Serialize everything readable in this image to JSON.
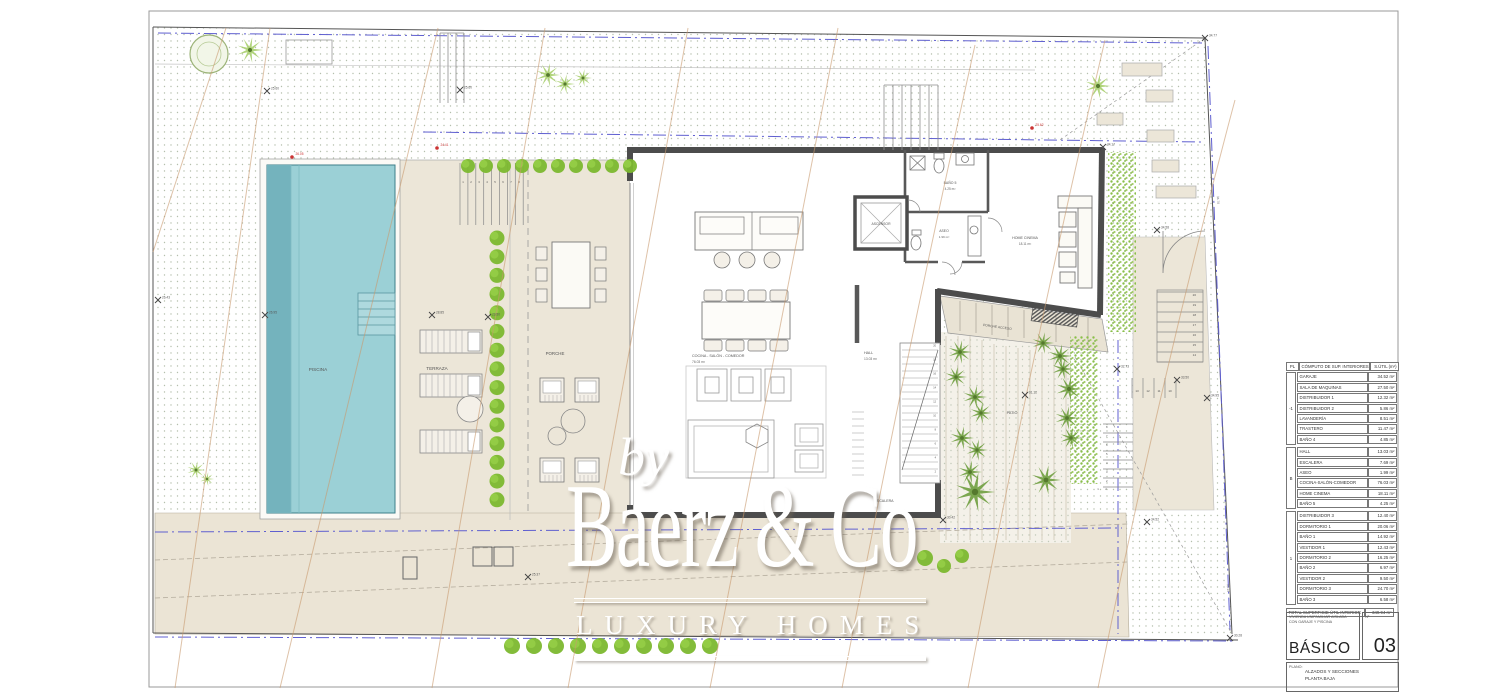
{
  "watermark": {
    "by": "by",
    "brand": "Baerz & Co",
    "tagline": "LUXURY HOMES"
  },
  "plan_labels": {
    "piscina": "PISCINA",
    "terraza": "TERRAZA",
    "porche": "PORCHE",
    "cocina": "COCINA - SALÓN - COMEDOR",
    "cocina_area": "76.03 m²",
    "hall": "HALL",
    "hall_area": "13.03 m²",
    "ascensor": "ASCENSOR",
    "aseo": "ASEO",
    "aseo_area": "1.99 m²",
    "bano5": "BAÑO 5",
    "bano5_area": "4.25 m²",
    "home_cinema": "HOME CINEMA",
    "home_cinema_area": "18.11 m²",
    "escalera": "ESCALERA",
    "patio": "PATIO",
    "porche_acceso": "PORCHE ACCESO"
  },
  "survey_marks": [
    {
      "x": 267,
      "y": 91,
      "v": "25.60"
    },
    {
      "x": 460,
      "y": 90,
      "v": "25.60"
    },
    {
      "x": 265,
      "y": 315,
      "v": "26.95"
    },
    {
      "x": 432,
      "y": 315,
      "v": "28.85"
    },
    {
      "x": 488,
      "y": 317,
      "v": "29.50"
    },
    {
      "x": 1025,
      "y": 395,
      "v": "31.12"
    },
    {
      "x": 1117,
      "y": 369,
      "v": "32.73"
    },
    {
      "x": 1177,
      "y": 380,
      "v": "33.50"
    },
    {
      "x": 1207,
      "y": 398,
      "v": "34.95"
    },
    {
      "x": 1103,
      "y": 147,
      "v": "34.17"
    },
    {
      "x": 1157,
      "y": 230,
      "v": "34.58"
    },
    {
      "x": 943,
      "y": 520,
      "v": "30.42"
    },
    {
      "x": 1147,
      "y": 522,
      "v": "34.52"
    },
    {
      "x": 528,
      "y": 577,
      "v": "25.37"
    },
    {
      "x": 1230,
      "y": 638,
      "v": "30.28"
    },
    {
      "x": 1205,
      "y": 38,
      "v": "34.77"
    },
    {
      "x": 158,
      "y": 300,
      "v": "26.43"
    }
  ],
  "red_marks": [
    {
      "x": 292,
      "y": 157,
      "v": "26.05"
    },
    {
      "x": 437,
      "y": 148,
      "v": "24.41"
    },
    {
      "x": 1032,
      "y": 128,
      "v": "25.62"
    }
  ],
  "dim_labels": [
    {
      "x": 1217,
      "y": 200,
      "v": "34.78",
      "rot": 88
    },
    {
      "x": 1227,
      "y": 588,
      "v": "30.14",
      "rot": 88
    }
  ],
  "stairs": {
    "right_upper": [
      "20",
      "19",
      "18",
      "17",
      "16",
      "15",
      "14"
    ],
    "right_mid": [
      "13",
      "12",
      "11",
      "10"
    ],
    "patio_right": [
      "8",
      "7",
      "6",
      "5",
      "4",
      "3",
      "2"
    ],
    "patio_bottom": [
      "1",
      "2"
    ],
    "porch_top": [
      "1",
      "2",
      "3",
      "4",
      "5",
      "6",
      "7",
      "8"
    ],
    "escalera_nums": [
      "20",
      "19",
      "18",
      "17",
      "16",
      "15",
      "14",
      "13",
      "12",
      "11",
      "10",
      "9",
      "8",
      "7",
      "6",
      "5",
      "4",
      "3",
      "2",
      "1"
    ]
  },
  "area_table": {
    "header": {
      "col_pl": "PL",
      "col_name": "CÓMPUTO DE SUP. INTERIORES",
      "col_area": "S.ÚTIL (m²)"
    },
    "groups": [
      {
        "floor": "-1",
        "rows": [
          [
            "GARAJE",
            "34.52 m²"
          ],
          [
            "SALA DE MAQUINAS",
            "27.50 m²"
          ],
          [
            "DISTRIBUIDOR 1",
            "12.32 m²"
          ],
          [
            "DISTRIBUIDOR 2",
            "5.86 m²"
          ],
          [
            "LAVANDERÍA",
            "8.51 m²"
          ],
          [
            "TRASTERO",
            "11.47 m²"
          ],
          [
            "BAÑO 4",
            "4.85 m²"
          ]
        ]
      },
      {
        "floor": "B",
        "rows": [
          [
            "HALL",
            "13.03 m²"
          ],
          [
            "ESCALERA",
            "7.69 m²"
          ],
          [
            "ASEO",
            "1.99 m²"
          ],
          [
            "COCINA-SALÓN-COMEDOR",
            "76.03 m²"
          ],
          [
            "HOME CINEMA",
            "18.11 m²"
          ],
          [
            "BAÑO 5",
            "4.25 m²"
          ]
        ]
      },
      {
        "floor": "1",
        "rows": [
          [
            "DISTRIBUIDOR 3",
            "12.40 m²"
          ],
          [
            "DORMITORIO 1",
            "20.06 m²"
          ],
          [
            "BAÑO 1",
            "14.92 m²"
          ],
          [
            "VESTIDOR 1",
            "12.43 m²"
          ],
          [
            "DORMITORIO 2",
            "16.25 m²"
          ],
          [
            "BAÑO 2",
            "6.97 m²"
          ],
          [
            "VESTIDOR 2",
            "9.50 m²"
          ],
          [
            "DORMITORIO 3",
            "24.70 m²"
          ],
          [
            "BAÑO 3",
            "6.58 m²"
          ]
        ]
      }
    ],
    "total_label": "TOTAL SUPERFICIE ÚTIL INTERIOR",
    "total_value": "349.94 m²"
  },
  "title_block": {
    "project_line1": "VIVIENDA UNIFAMILIAR AISLADA",
    "project_line2": "CON GARAJE Y PISCINA",
    "phase": "BÁSICO",
    "number_label": "Nº",
    "number": "03",
    "plano_label": "PLANO:",
    "plano_line1": "ALZADOS Y SECCIONES",
    "plano_line2": "PLANTA BAJA",
    "situacion_label": "SITUACIÓN"
  }
}
